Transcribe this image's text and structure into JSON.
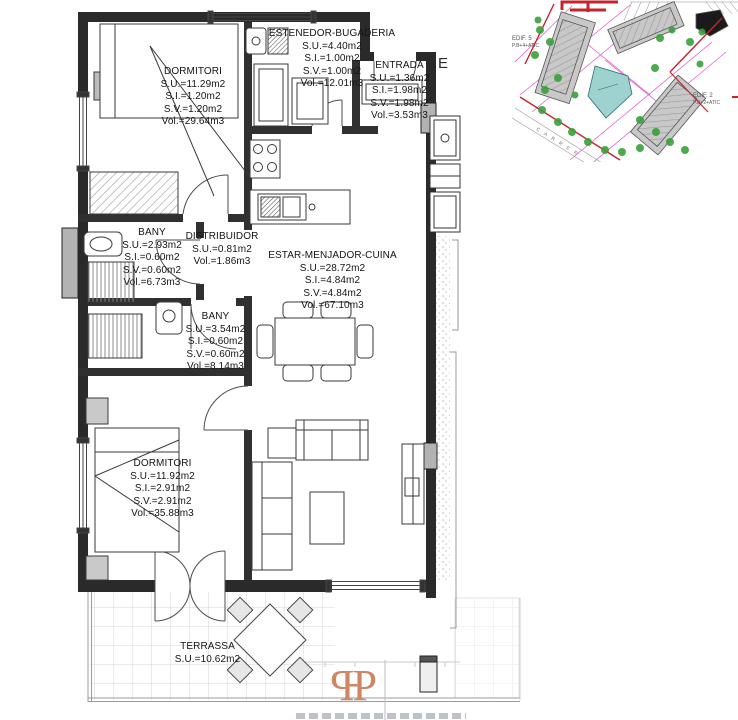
{
  "plan": {
    "rooms": [
      {
        "name": "DORMITORI",
        "su": "S.U.=11.29m2",
        "si": "S.I.=1.20m2",
        "sv": "S.V.=1.20m2",
        "vol": "Vol.=29.64m3"
      },
      {
        "name": "ESTENEDOR-BUGADERIA",
        "su": "S.U.=4.40m2",
        "si": "S.I.=1.00m2",
        "sv": "S.V.=1.00m2",
        "vol": "Vol.=12.01m3"
      },
      {
        "name": "ENTRADA",
        "su": "S.U.=1.36m2",
        "si": "S.I.=1.98m2",
        "sv": "S.V.=1.98m2",
        "vol": "Vol.=3.53m3"
      },
      {
        "name": "BANY",
        "su": "S.U.=2.93m2",
        "si": "S.I.=0.60m2",
        "sv": "S.V.=0.60m2",
        "vol": "Vol.=6.73m3"
      },
      {
        "name": "DISTRIBUIDOR",
        "su": "S.U.=0.81m2",
        "vol": "Vol.=1.86m3"
      },
      {
        "name": "ESTAR-MENJADOR-CUINA",
        "su": "S.U.=28.72m2",
        "si": "S.I.=4.84m2",
        "sv": "S.V.=4.84m2",
        "vol": "Vol.=67.10m3"
      },
      {
        "name": "BANY",
        "su": "S.U.=3.54m2",
        "si": "S.I.=0.60m2",
        "sv": "S.V.=0.60m2",
        "vol": "Vol.=8.14m3"
      },
      {
        "name": "DORMITORI",
        "su": "S.U.=11.92m2",
        "si": "S.I.=2.91m2",
        "sv": "S.V.=2.91m2",
        "vol": "Vol.=35.88m3"
      },
      {
        "name": "TERRASSA",
        "su": "S.U.=10.62m2"
      }
    ],
    "edge_label": "E"
  },
  "site_plan": {
    "edif2": "EDIF. 2",
    "edif2_floors": "P.B+2+ATIC",
    "edif5": "EDIF. 5",
    "edif5_floors": "P.B+4+ATIC",
    "street": "C A R R E R",
    "colors": {
      "boundary": "#c4242b",
      "pool": "#9ed2cf",
      "tree": "#3aa03a",
      "grid_line": "#e255c8",
      "building": "#c8c8c8"
    }
  },
  "logo": {
    "left": "P",
    "sep": "-",
    "right": "P",
    "color": "#cf8663"
  }
}
